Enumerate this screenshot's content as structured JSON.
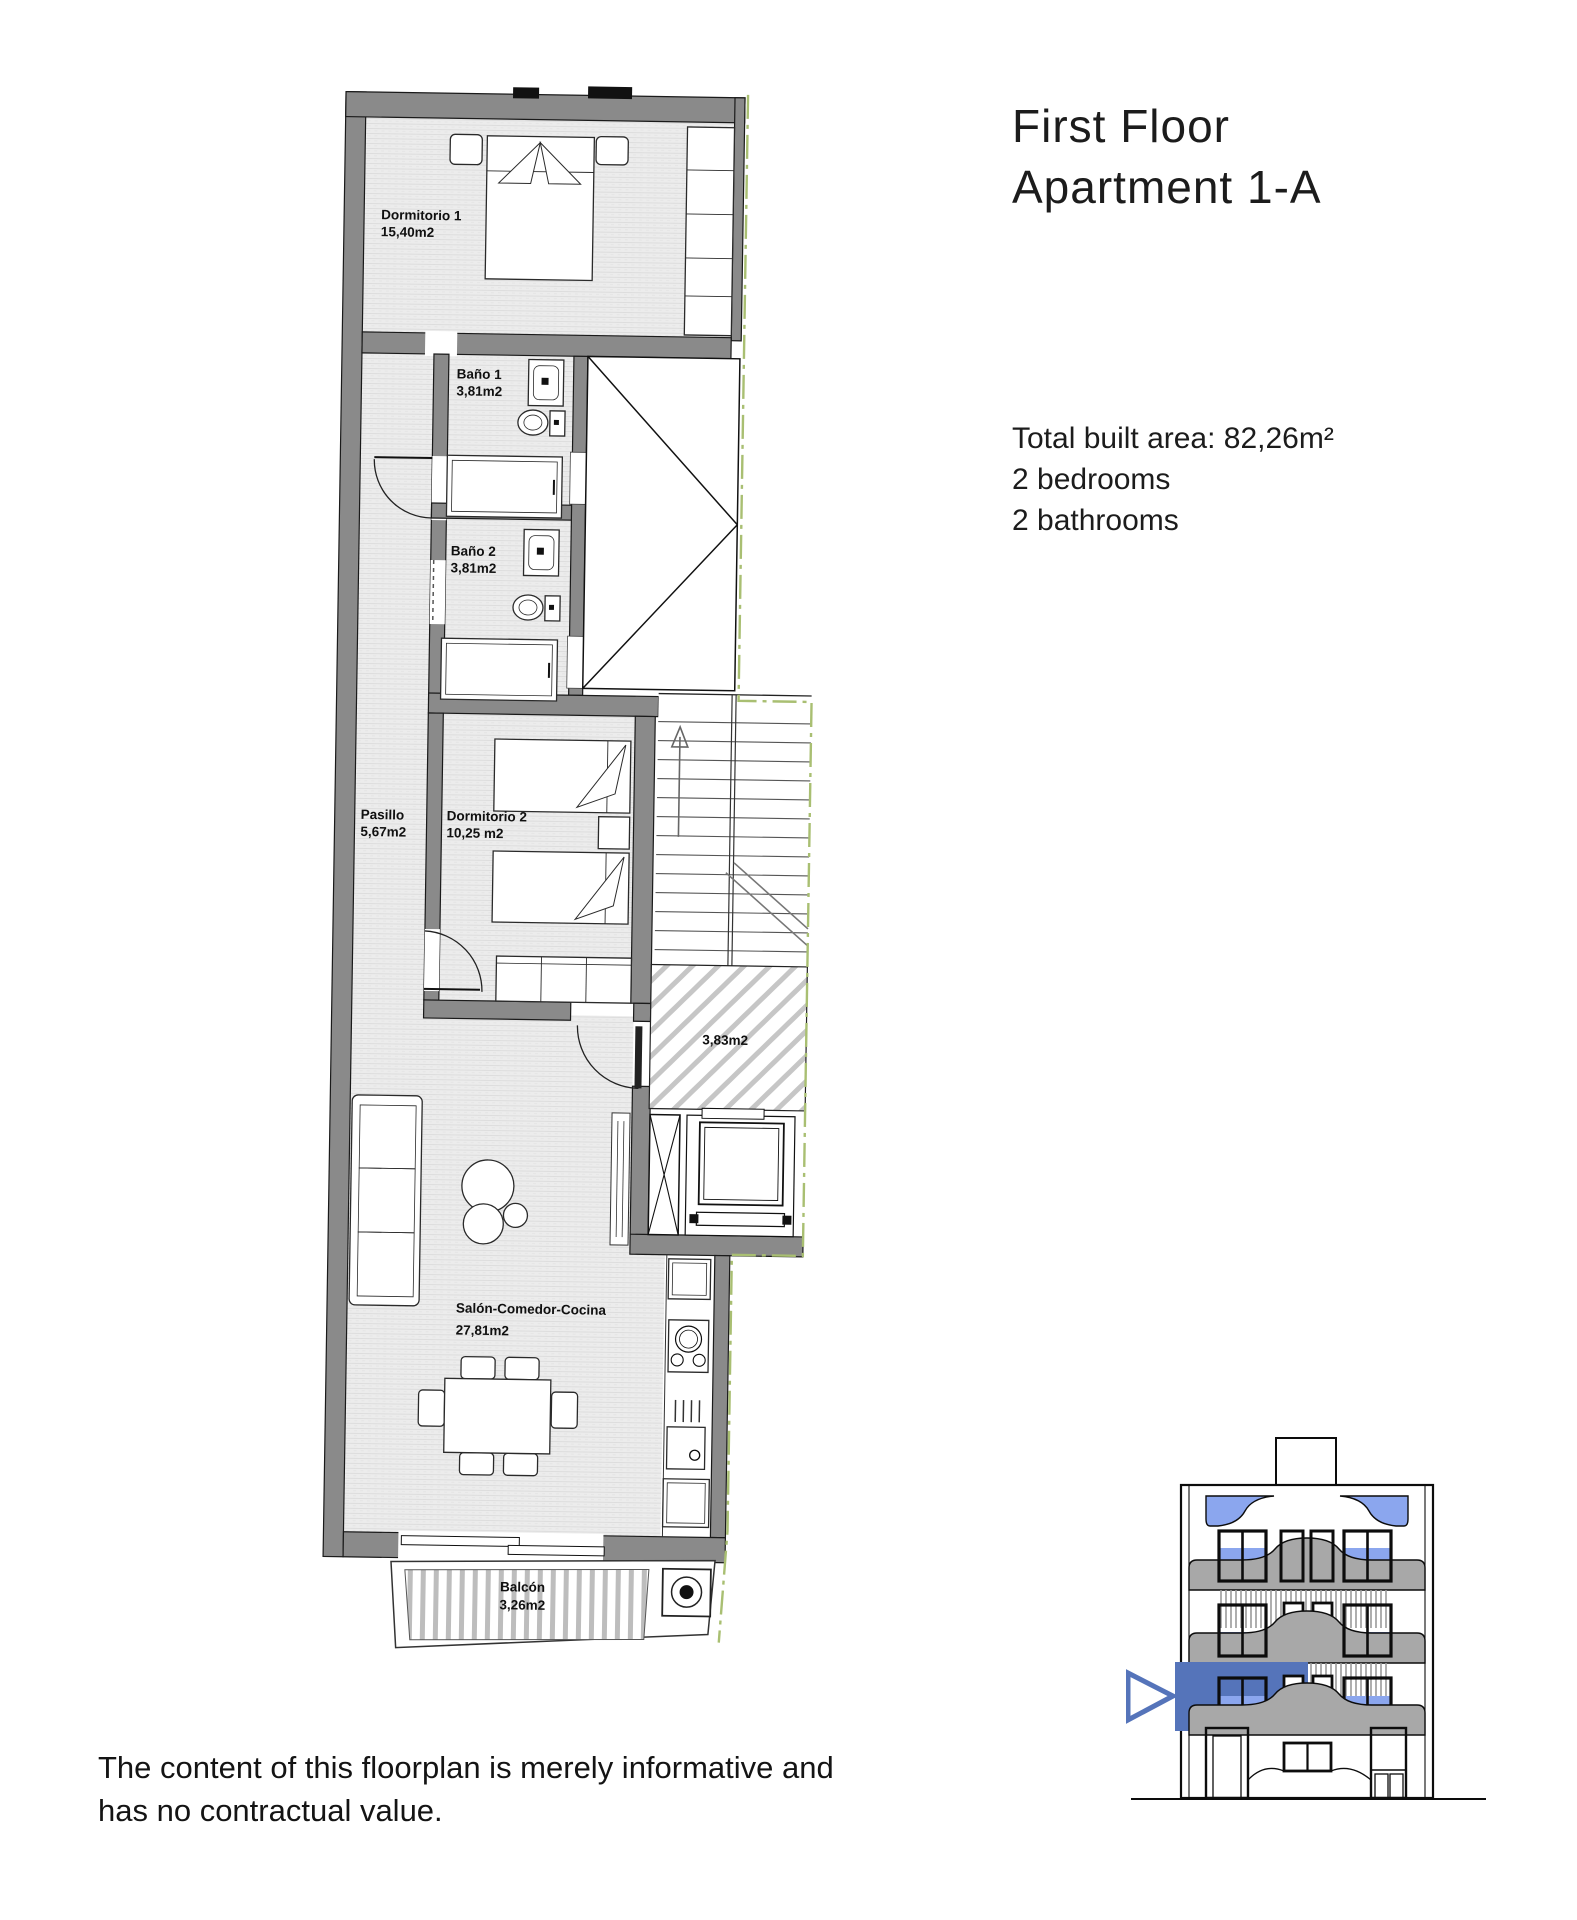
{
  "header": {
    "title_line1": "First Floor",
    "title_line2": "Apartment 1-A"
  },
  "summary": {
    "total_area": "Total built area: 82,26m²",
    "bedrooms": "2 bedrooms",
    "bathrooms": "2 bathrooms"
  },
  "rooms": {
    "dormitorio1": {
      "name": "Dormitorio 1",
      "area": "15,40m2"
    },
    "bano1": {
      "name": "Baño 1",
      "area": "3,81m2"
    },
    "bano2": {
      "name": "Baño 2",
      "area": "3,81m2"
    },
    "pasillo": {
      "name": "Pasillo",
      "area": "5,67m2"
    },
    "dormitorio2": {
      "name": "Dormitorio 2",
      "area": "10,25 m2"
    },
    "landing": {
      "area": "3,83m2"
    },
    "salon": {
      "name": "Salón-Comedor-Cocina",
      "area": "27,81m2"
    },
    "balcon": {
      "name": "Balcón",
      "area": "3,26m2"
    }
  },
  "disclaimer": {
    "line1": "The content of this floorplan is merely informative and",
    "line2": "has no contractual value."
  },
  "colors": {
    "wall_gray": "#8a8a8a",
    "floor_gray": "#ececec",
    "boundary_green": "#a9bf72",
    "glass_blue": "#8ba6ee",
    "selected_blue": "#5574ba",
    "balcony_gray": "#a8a8a8"
  }
}
